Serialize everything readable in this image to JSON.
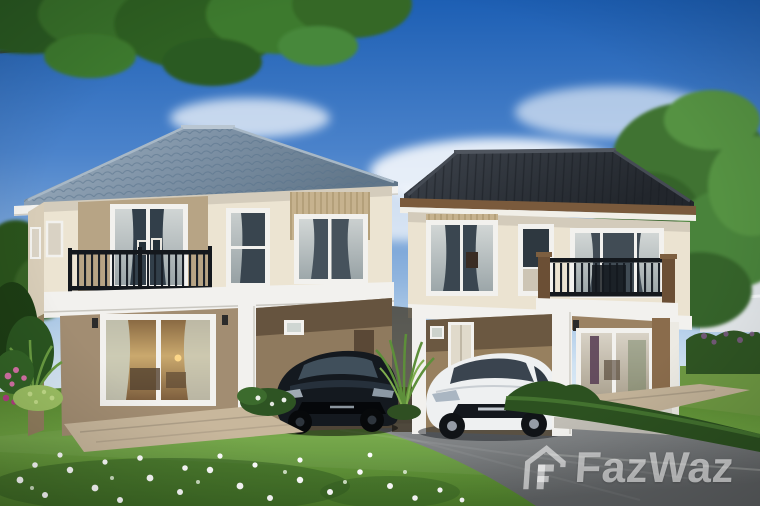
{
  "watermark": {
    "brand_text": "FazWaz",
    "logo_icon": "fazwaz-house-logo",
    "color": "#ffffff",
    "opacity": 0.55
  },
  "scene": {
    "setting": "daytime exterior 3D rendering of a housing development",
    "objects": [
      "two-story house with blue-grey tiled hip roof (left)",
      "two-story house with dark charcoal hip roof (right)",
      "black sedan parked in left carport",
      "white sedan parked in right carport",
      "overhanging tree canopy (top left)",
      "tall tree beside right house",
      "neighbouring white house (far right background)",
      "front lawn with scattered white flowers",
      "shrubs with pink and magenta flowers (left edge)",
      "grey driveway and low trimmed hedges",
      "balconies with black metal railings",
      "sliding glass doors with warm interior light"
    ]
  },
  "palette": {
    "sky_top": "#1d5fb4",
    "sky_horizon": "#e8f2f9",
    "roof_left_house": "#7e92a6",
    "roof_right_house": "#2f343b",
    "wall_upper": "#ece4d2",
    "wall_lower": "#a28d72",
    "accent_panel": "#b7a485",
    "trim_white": "#f2f1ee",
    "fascia_brown": "#7c5c3c",
    "railing_black": "#1a2028",
    "lawn_green": "#5d8c35",
    "driveway_grey": "#84888a",
    "car_left": "#14191f",
    "car_right": "#eef0f1",
    "foliage_green": "#3f7330"
  }
}
